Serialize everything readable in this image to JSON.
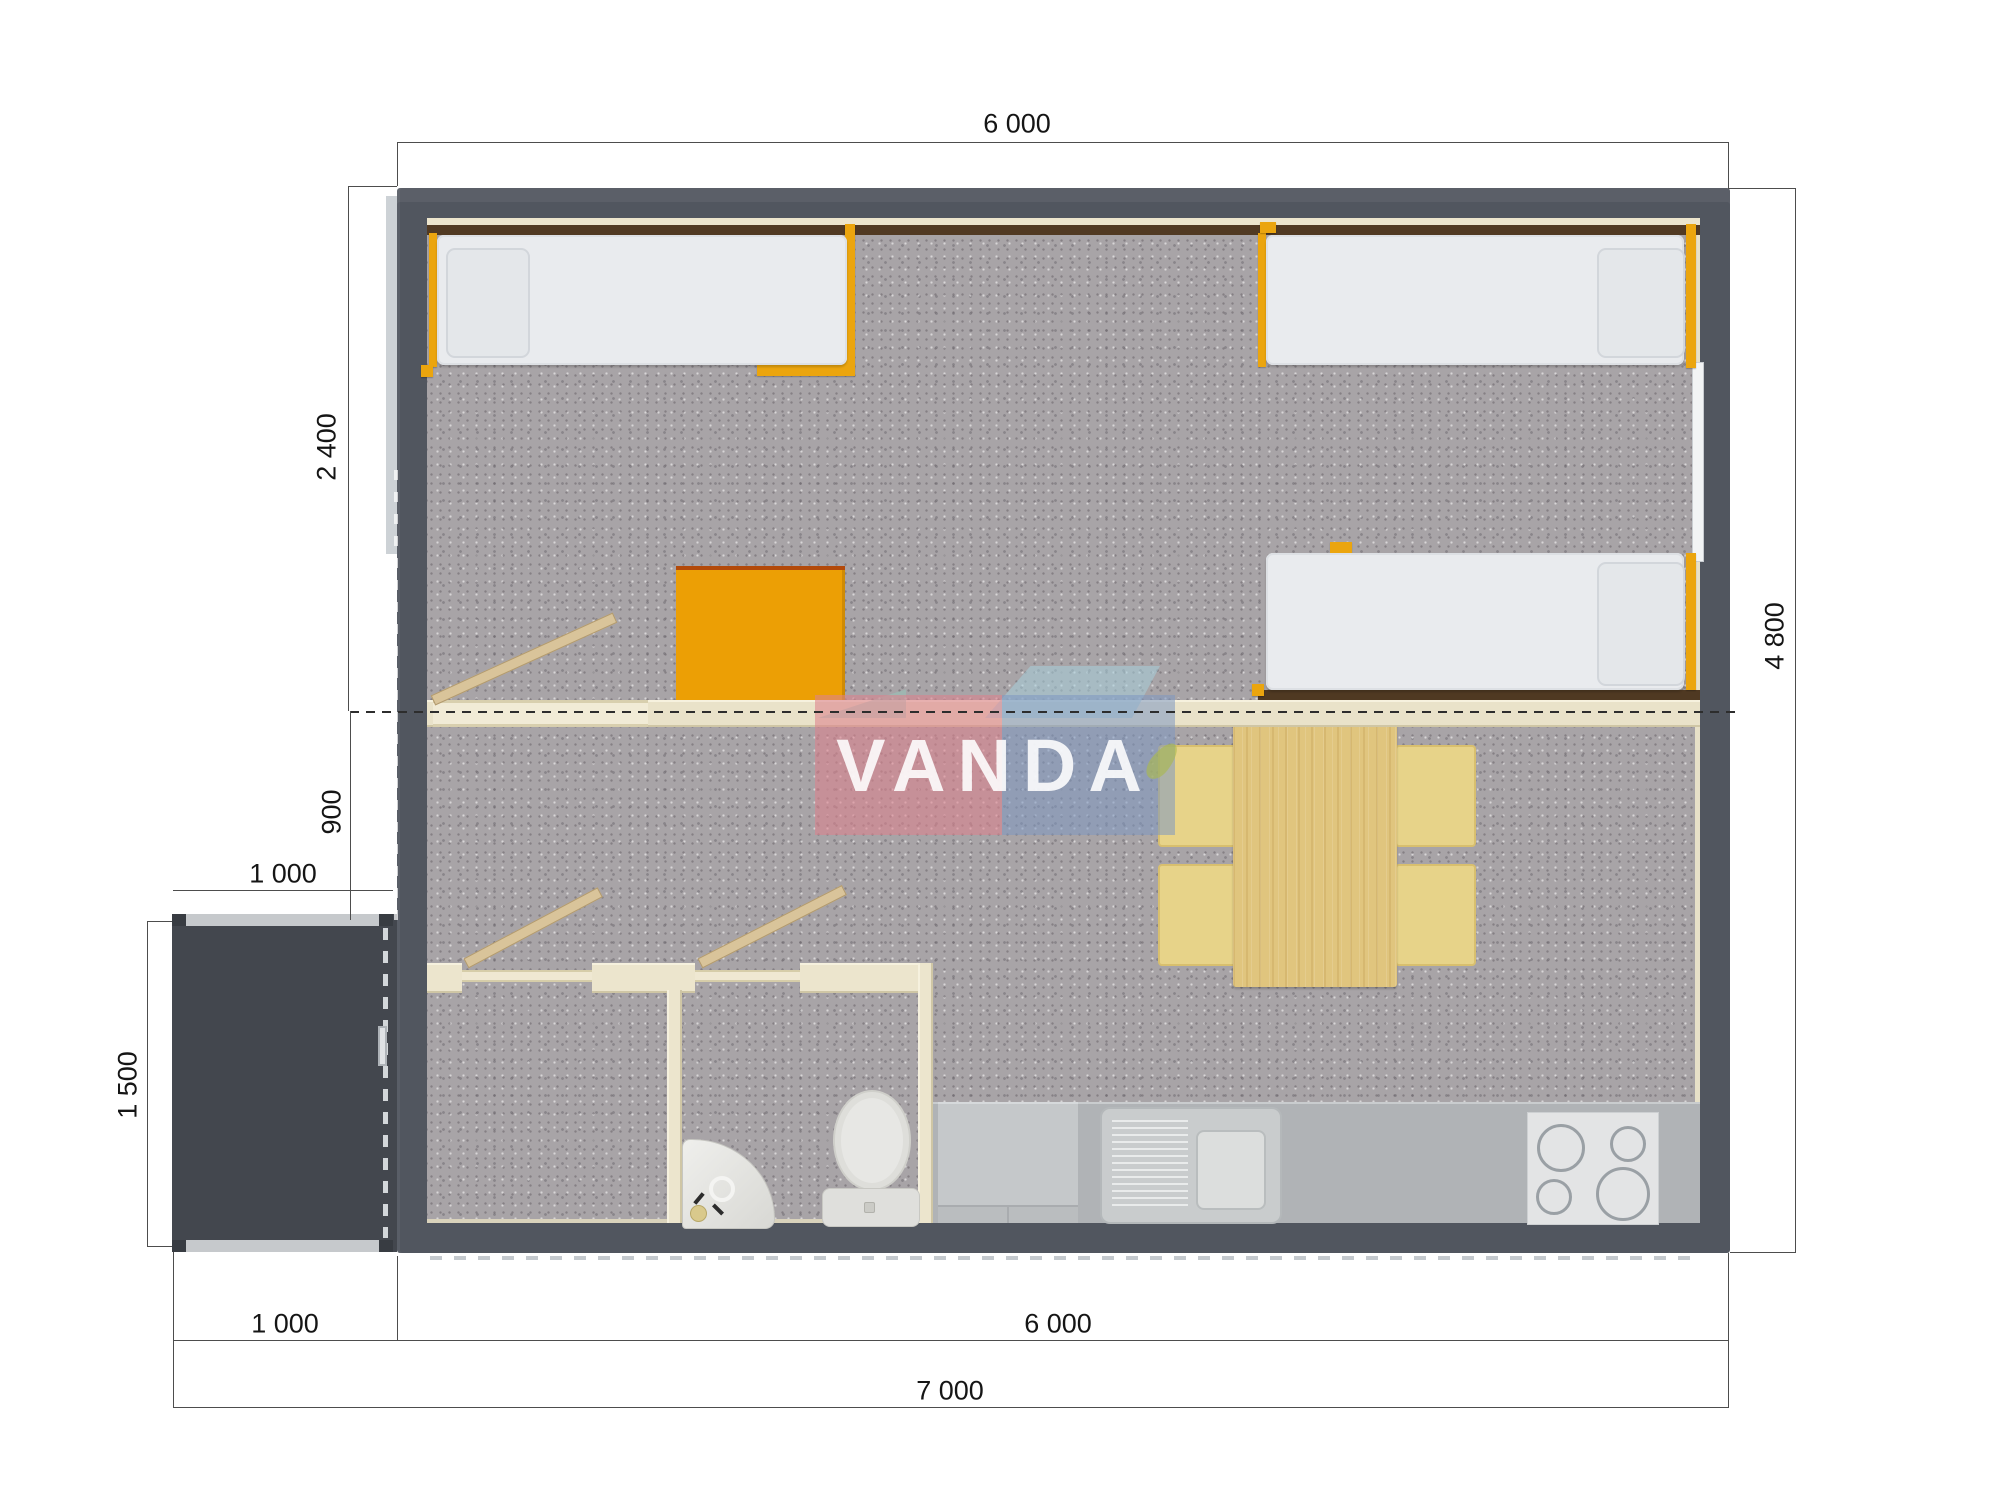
{
  "watermark": {
    "text": "VANDA"
  },
  "dimensions": {
    "top_width": "6 000",
    "bedroom_depth": "2 400",
    "hall_depth": "900",
    "porch_width_top": "1 000",
    "porch_depth": "1 500",
    "building_depth": "4 800",
    "porch_width_bottom": "1 000",
    "building_width_bottom": "6 000",
    "total_width": "7 000"
  },
  "icons": {
    "bed": "single-bed-icon",
    "pillow": "pillow-icon",
    "desk": "desk-icon",
    "door": "door-leaf-icon",
    "dining_table": "dining-table-icon",
    "chair": "chair-icon",
    "toilet": "toilet-icon",
    "washbasin": "washbasin-icon",
    "kitchen_sink": "kitchen-sink-icon",
    "cooktop": "cooktop-icon",
    "window": "window-icon",
    "door_handle": "door-handle-icon"
  },
  "colors": {
    "wall": "#51565f",
    "floor": "#a8a4a7",
    "accent_orange": "#eba50e",
    "partition_wood": "#ece5cd",
    "dark_wood_band": "#513a23",
    "table_wood": "#e0c57e",
    "chair": "#e7d389",
    "counter": "#b0b3b6",
    "porch": "#43474e",
    "mattress": "#e9ebee",
    "watermark_pink": "#dd8290",
    "watermark_blue": "#7d98c1",
    "dimension_line": "#4d4d4d"
  }
}
